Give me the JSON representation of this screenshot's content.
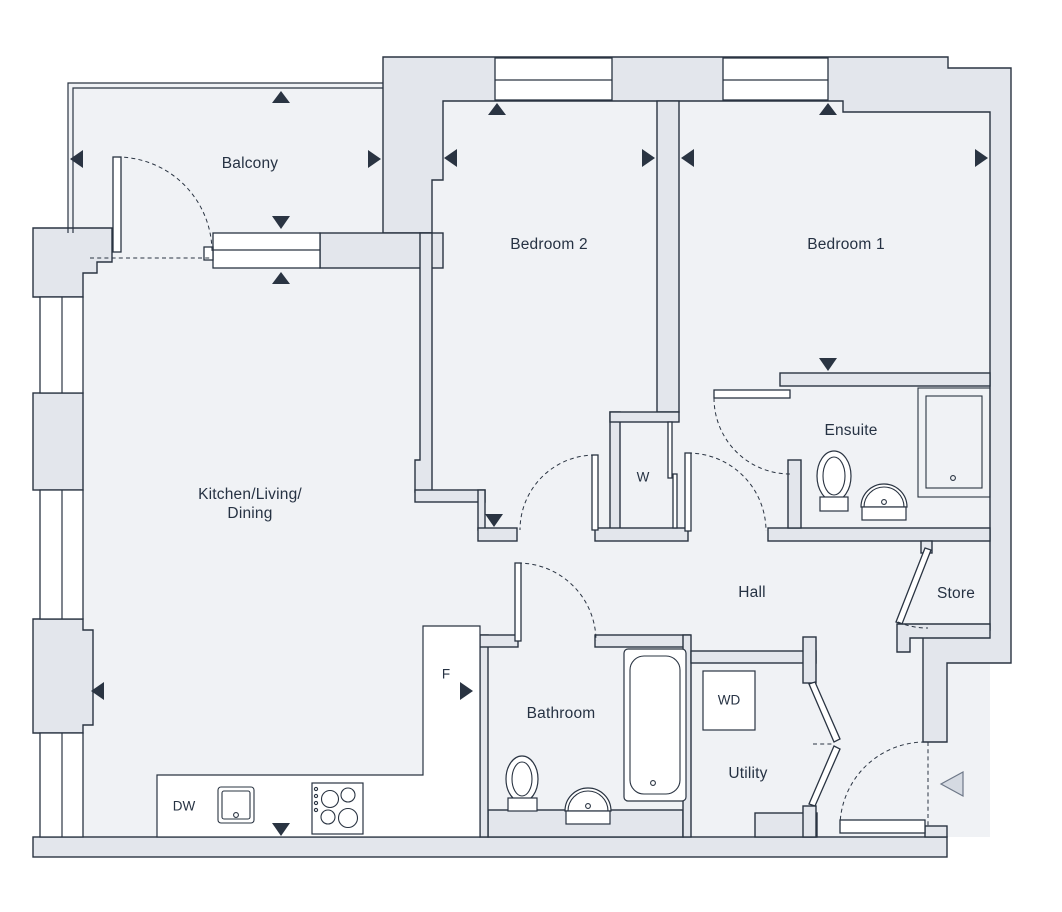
{
  "floorplan": {
    "rooms": {
      "balcony": {
        "label": "Balcony"
      },
      "bedroom2": {
        "label": "Bedroom 2"
      },
      "bedroom1": {
        "label": "Bedroom 1"
      },
      "kitchen": {
        "label_line1": "Kitchen/Living/",
        "label_line2": "Dining"
      },
      "ensuite": {
        "label": "Ensuite"
      },
      "hall": {
        "label": "Hall"
      },
      "store": {
        "label": "Store"
      },
      "bathroom": {
        "label": "Bathroom"
      },
      "utility": {
        "label": "Utility"
      },
      "wardrobe": {
        "label": "W"
      }
    },
    "appliances": {
      "dishwasher": {
        "label": "DW"
      },
      "fridge": {
        "label": "F"
      },
      "washer_dryer": {
        "label": "WD"
      }
    },
    "colors": {
      "line": "#2a3442",
      "wall_fill": "#e3e6ec",
      "room_fill": "#f0f2f5",
      "white": "#ffffff",
      "entry_arrow_fill": "#d5dae2"
    }
  }
}
